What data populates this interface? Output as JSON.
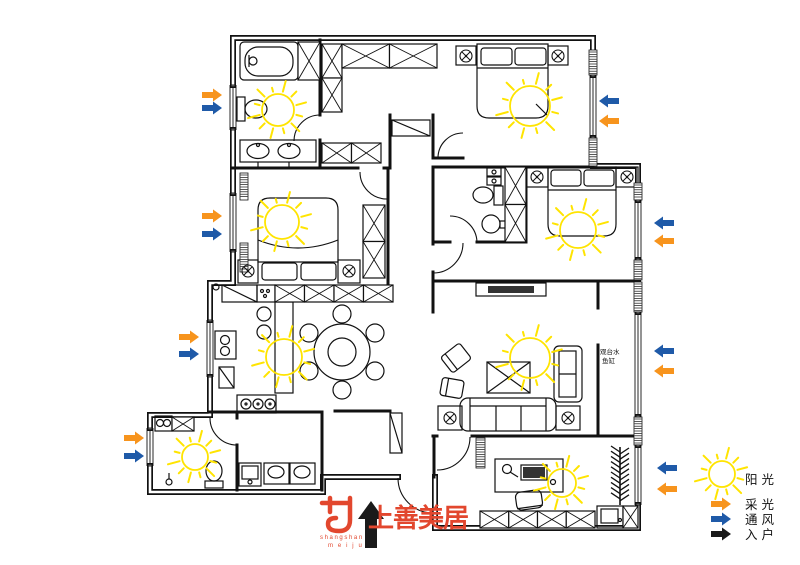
{
  "legend": {
    "items": [
      {
        "key": "sunshine",
        "label": "阳光",
        "symbol": "sun",
        "color": "#ffe400"
      },
      {
        "key": "daylight",
        "label": "采光",
        "symbol": "arrow",
        "color": "#f7941d"
      },
      {
        "key": "ventilation",
        "label": "通风",
        "symbol": "arrow",
        "color": "#1f5aa8"
      },
      {
        "key": "entry",
        "label": "入户",
        "symbol": "arrow",
        "color": "#1a1a1a"
      }
    ]
  },
  "logo": {
    "latin_top": "shangshan",
    "latin_bottom": "m e i j u",
    "cjk": "上善美居",
    "color": "#e2472e"
  },
  "balcony_note": {
    "line1": "观台水",
    "line2": "鱼缸"
  },
  "suns": [
    {
      "x": 278,
      "y": 110,
      "r": 16
    },
    {
      "x": 530,
      "y": 106,
      "r": 20
    },
    {
      "x": 282,
      "y": 222,
      "r": 17
    },
    {
      "x": 578,
      "y": 230,
      "r": 18
    },
    {
      "x": 284,
      "y": 357,
      "r": 18
    },
    {
      "x": 530,
      "y": 358,
      "r": 20
    },
    {
      "x": 195,
      "y": 457,
      "r": 13
    },
    {
      "x": 562,
      "y": 483,
      "r": 14
    }
  ],
  "arrows": [
    {
      "x": 212,
      "y": 95,
      "dir": "right",
      "type": "daylight"
    },
    {
      "x": 212,
      "y": 108,
      "dir": "right",
      "type": "ventilation"
    },
    {
      "x": 212,
      "y": 216,
      "dir": "right",
      "type": "daylight"
    },
    {
      "x": 212,
      "y": 234,
      "dir": "right",
      "type": "ventilation"
    },
    {
      "x": 189,
      "y": 337,
      "dir": "right",
      "type": "daylight"
    },
    {
      "x": 189,
      "y": 354,
      "dir": "right",
      "type": "ventilation"
    },
    {
      "x": 134,
      "y": 438,
      "dir": "right",
      "type": "daylight"
    },
    {
      "x": 134,
      "y": 456,
      "dir": "right",
      "type": "ventilation"
    },
    {
      "x": 609,
      "y": 101,
      "dir": "left",
      "type": "ventilation"
    },
    {
      "x": 609,
      "y": 121,
      "dir": "left",
      "type": "daylight"
    },
    {
      "x": 664,
      "y": 223,
      "dir": "left",
      "type": "ventilation"
    },
    {
      "x": 664,
      "y": 241,
      "dir": "left",
      "type": "daylight"
    },
    {
      "x": 664,
      "y": 351,
      "dir": "left",
      "type": "ventilation"
    },
    {
      "x": 664,
      "y": 371,
      "dir": "left",
      "type": "daylight"
    },
    {
      "x": 667,
      "y": 468,
      "dir": "left",
      "type": "ventilation"
    },
    {
      "x": 667,
      "y": 489,
      "dir": "left",
      "type": "daylight"
    },
    {
      "x": 371,
      "y": 524,
      "dir": "up",
      "type": "entry"
    }
  ]
}
